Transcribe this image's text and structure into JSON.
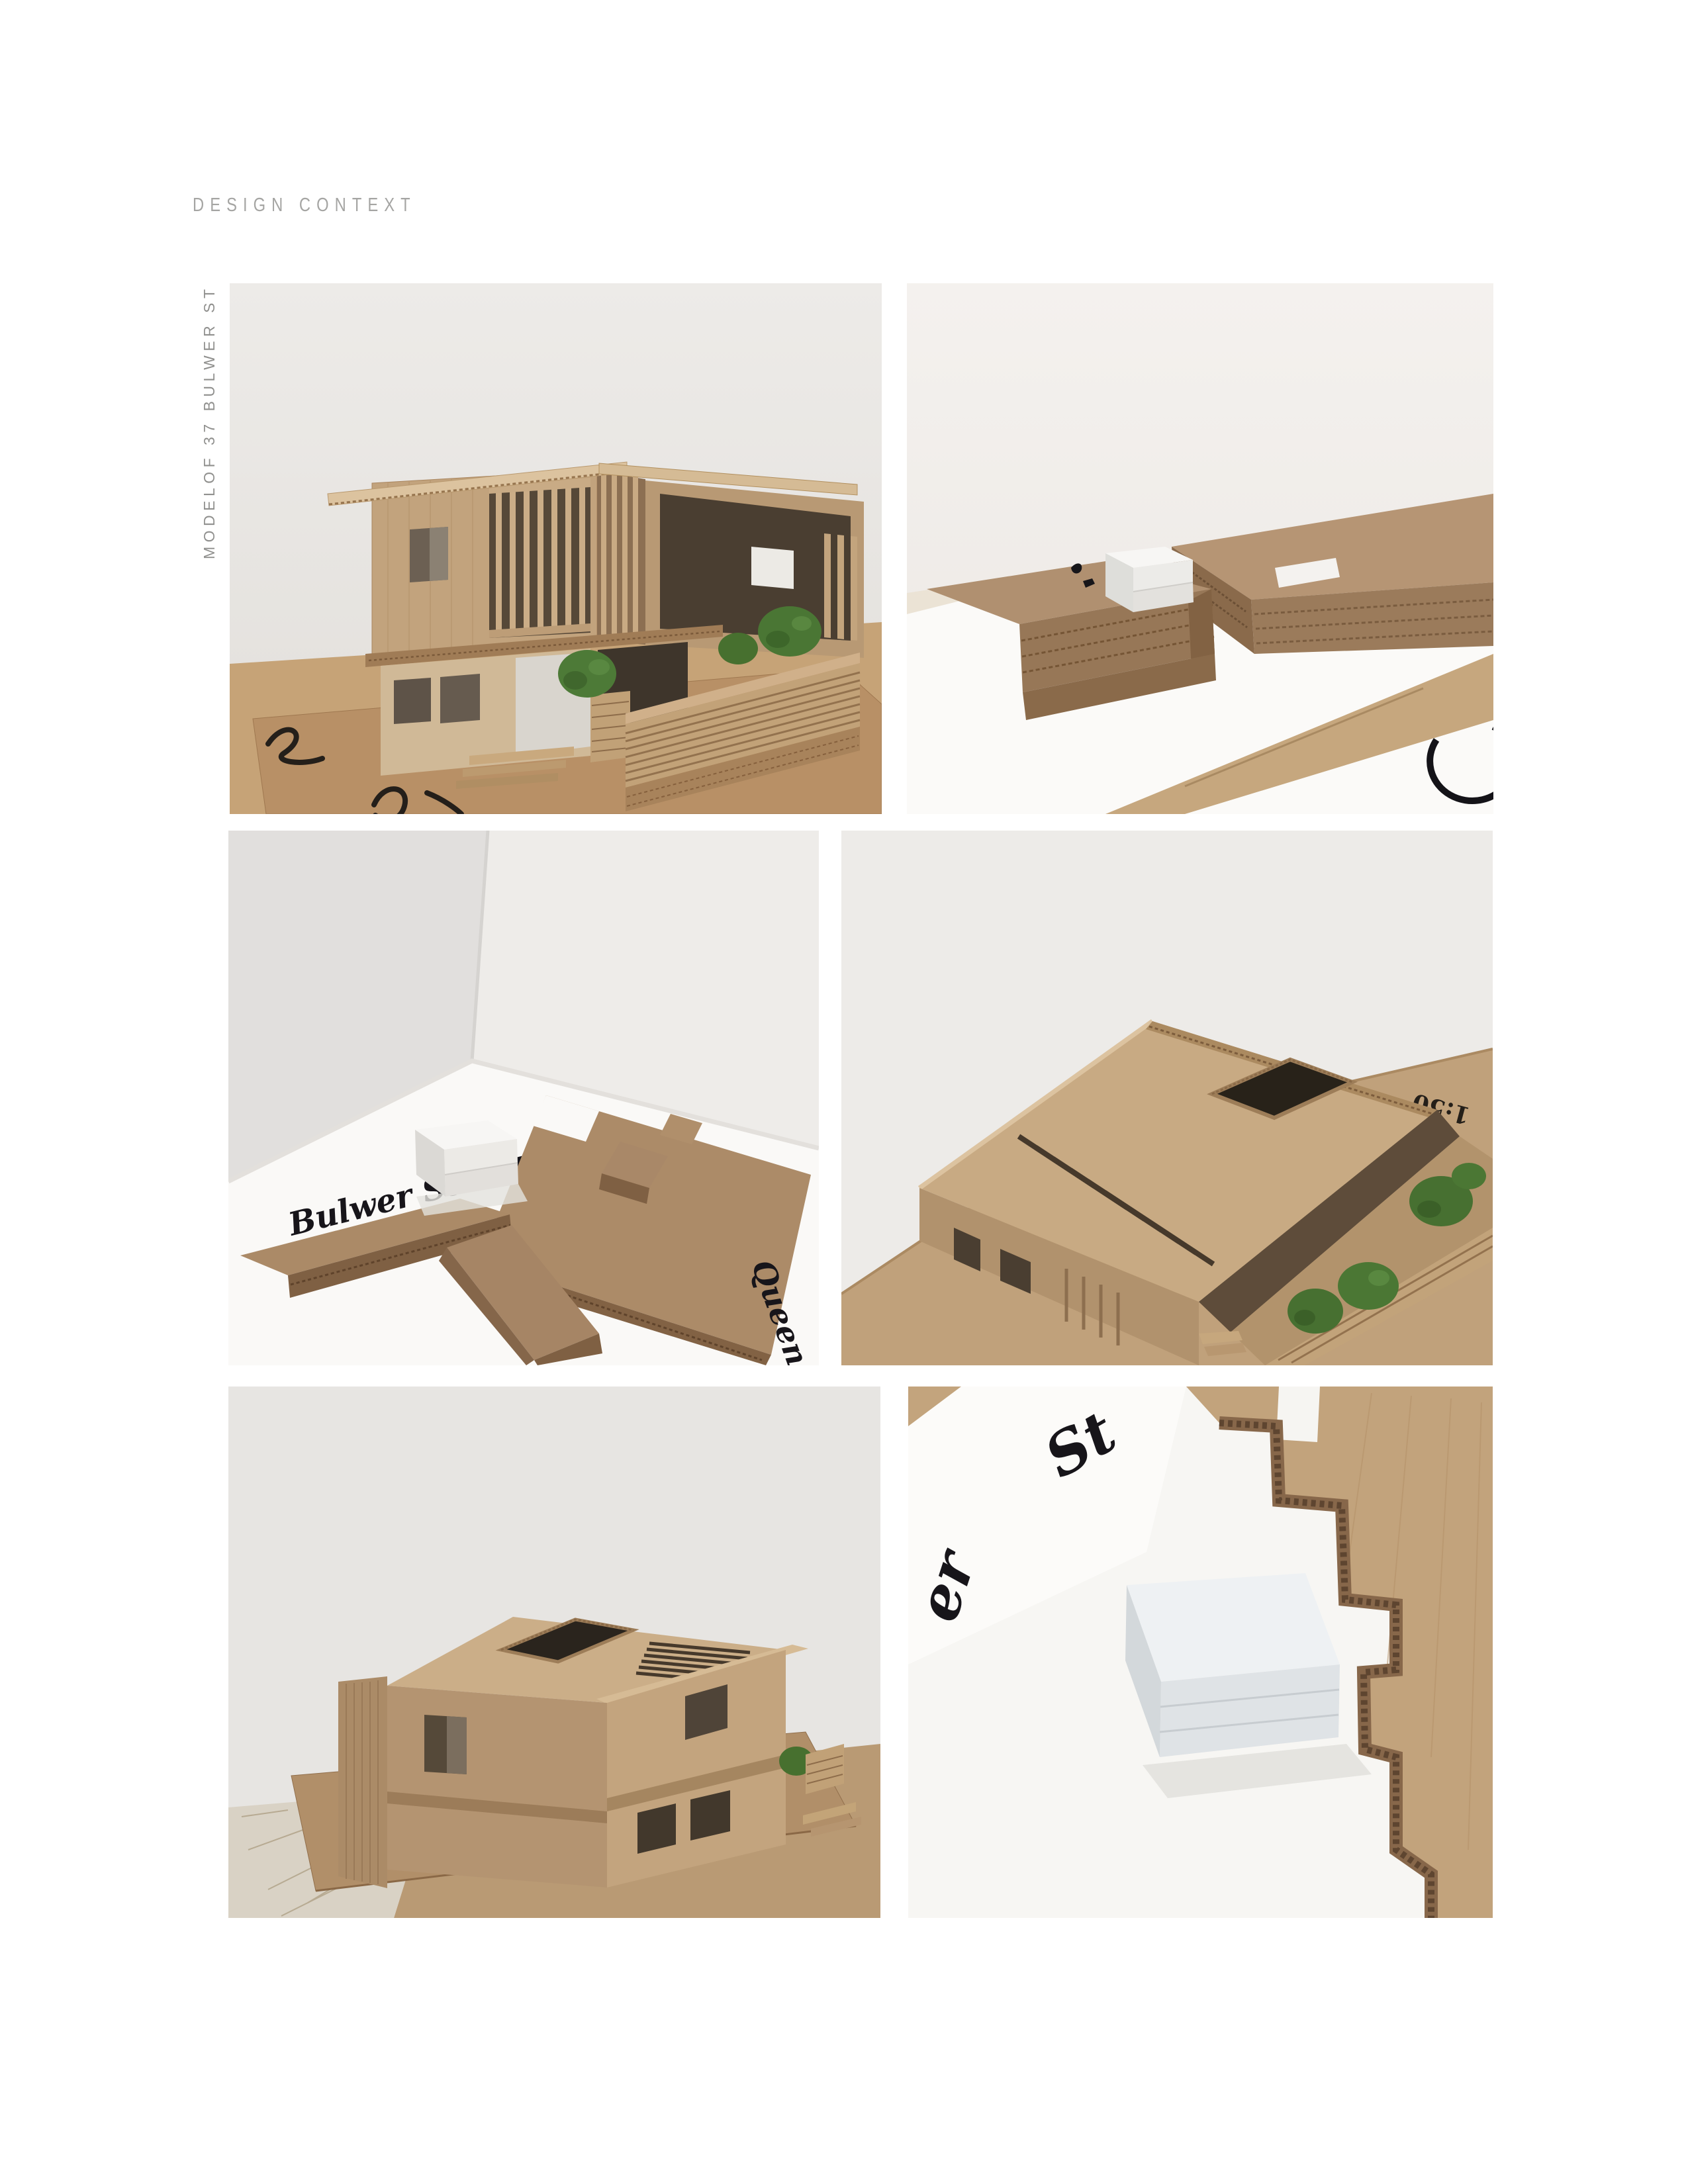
{
  "page": {
    "title": "DESIGN CONTEXT",
    "side_caption": "MODELOF 37 BULWER ST"
  },
  "handwriting": {
    "bulwer_street": "Bulwer Street",
    "queen_street": "Queen S",
    "scale_note": "1:50",
    "fragment_st": "St",
    "fragment_er": "er"
  },
  "colors": {
    "page_bg": "#ffffff",
    "title_gray": "#a5a5a3",
    "caption_gray": "#90908e",
    "wall_light": "#e9e7e4",
    "wall_white": "#f3f0ee",
    "base_white": "#faf9f7",
    "cardboard": "#c2a37d",
    "cardboard_dark": "#8a6a4b",
    "corrugation": "#7c5e41",
    "tree_green": "#4d7a37",
    "marker_black": "#17161a"
  }
}
